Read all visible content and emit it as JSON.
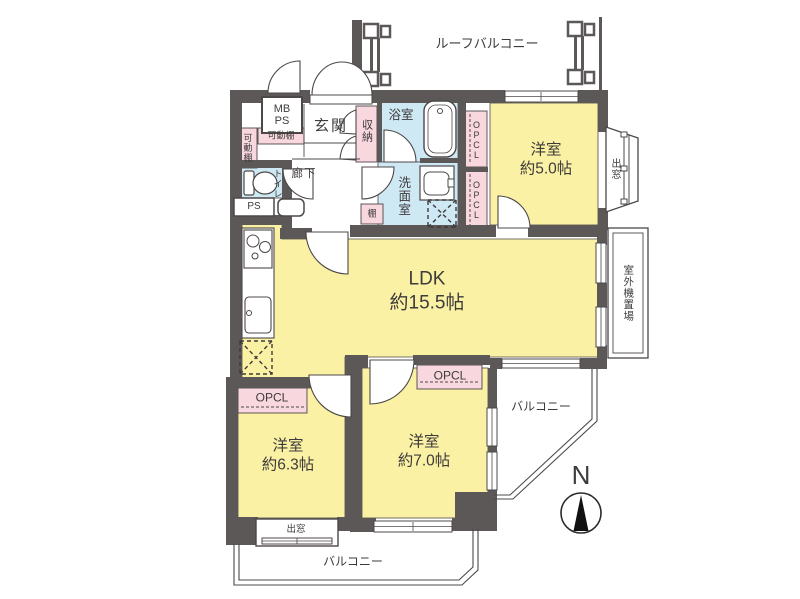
{
  "palette": {
    "wall": "#5d5858",
    "room_yellow": "#faf1a4",
    "wet_area_blue": "#cee8f4",
    "closet_pink": "#f8d7df",
    "line": "#4c4848",
    "text": "#3e3b3b"
  },
  "floorplan": {
    "labels": {
      "roof_balcony": "ルーフバルコニー",
      "mb_ps": "MB\nPS",
      "entrance": "玄関",
      "movable_shelf_h": "可動棚",
      "movable_shelf_v": "可動棚",
      "storage": "収納",
      "bathroom": "浴室",
      "toilet": "トイレ",
      "ps": "PS",
      "hallway": "廊下",
      "washroom": "洗面室",
      "shelf": "棚",
      "opcl_upper_1": "OPCL",
      "opcl_upper_2": "OPCL",
      "bedroom_5": "洋室\n約5.0帖",
      "bay_window_right": "出窓",
      "outdoor_unit_area": "室外機置場",
      "ldk": "LDK\n約15.5帖",
      "opcl_bedroom_63": "OPCL",
      "bedroom_63": "洋室\n約6.3帖",
      "opcl_bedroom_70": "OPCL",
      "bedroom_70": "洋室\n約7.0帖",
      "balcony_right": "バルコニー",
      "bay_window_bottom": "出窓",
      "balcony_bottom": "バルコニー",
      "compass_north": "N"
    }
  }
}
